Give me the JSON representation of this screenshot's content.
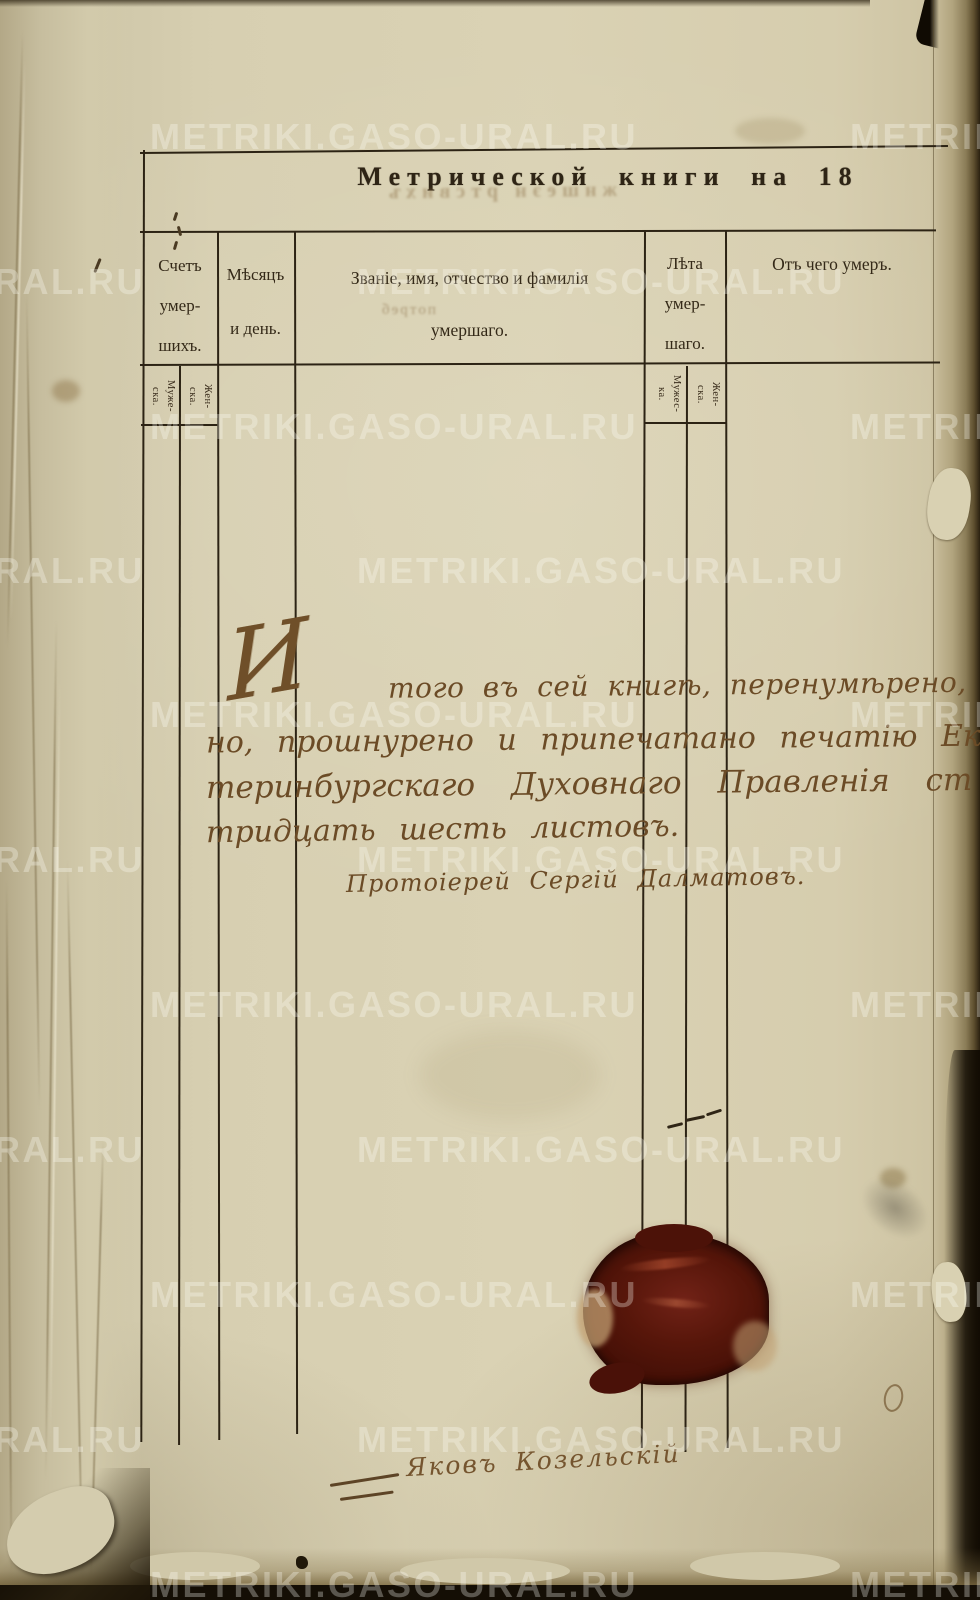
{
  "watermark": {
    "text": "METRIKI.GASO-URAL.RU"
  },
  "header": {
    "title": "Метрической книги на 18"
  },
  "bleed_through": {
    "row1": "жншеэн ртсвихъ",
    "row2": "потреб"
  },
  "table": {
    "columns": [
      {
        "id": "count",
        "lines": [
          "Счетъ",
          "умер-",
          "шихъ."
        ],
        "sub": [
          [
            "Муже-",
            "ска."
          ],
          [
            "Жен-",
            "ска."
          ]
        ]
      },
      {
        "id": "month",
        "lines": [
          "Мѣсяцъ",
          "и день."
        ]
      },
      {
        "id": "name",
        "lines": [
          "Званіе, имя, отчество и фамилія",
          "умершаго."
        ]
      },
      {
        "id": "age",
        "lines": [
          "Лѣта",
          "умер-",
          "шаго."
        ],
        "sub": [
          [
            "Мужес-",
            "ка."
          ],
          [
            "Жен-",
            "ска."
          ]
        ]
      },
      {
        "id": "cause",
        "lines": [
          "Отъ чего умеръ."
        ]
      }
    ]
  },
  "certification": {
    "initial": "И",
    "lines": [
      "того въ сей книгѣ, перенумѣрено, скрѣпле",
      "но, прошнурено и припечатано печатію Ека",
      "теринбургскаго Духовнаго Правленія ст",
      "тридцать шесть листовъ."
    ],
    "signature": "Протоіерей Сергій Далматовъ."
  },
  "annotations": {
    "bottom_signature": "Яковъ Козельскій"
  },
  "colors": {
    "paper": "#d8d0b2",
    "rule_ink": "#2c2314",
    "print_ink": "#342918",
    "handwriting_ink": "#6b4b26",
    "seal_wax": "#57160a",
    "watermark": "#ffffff"
  }
}
